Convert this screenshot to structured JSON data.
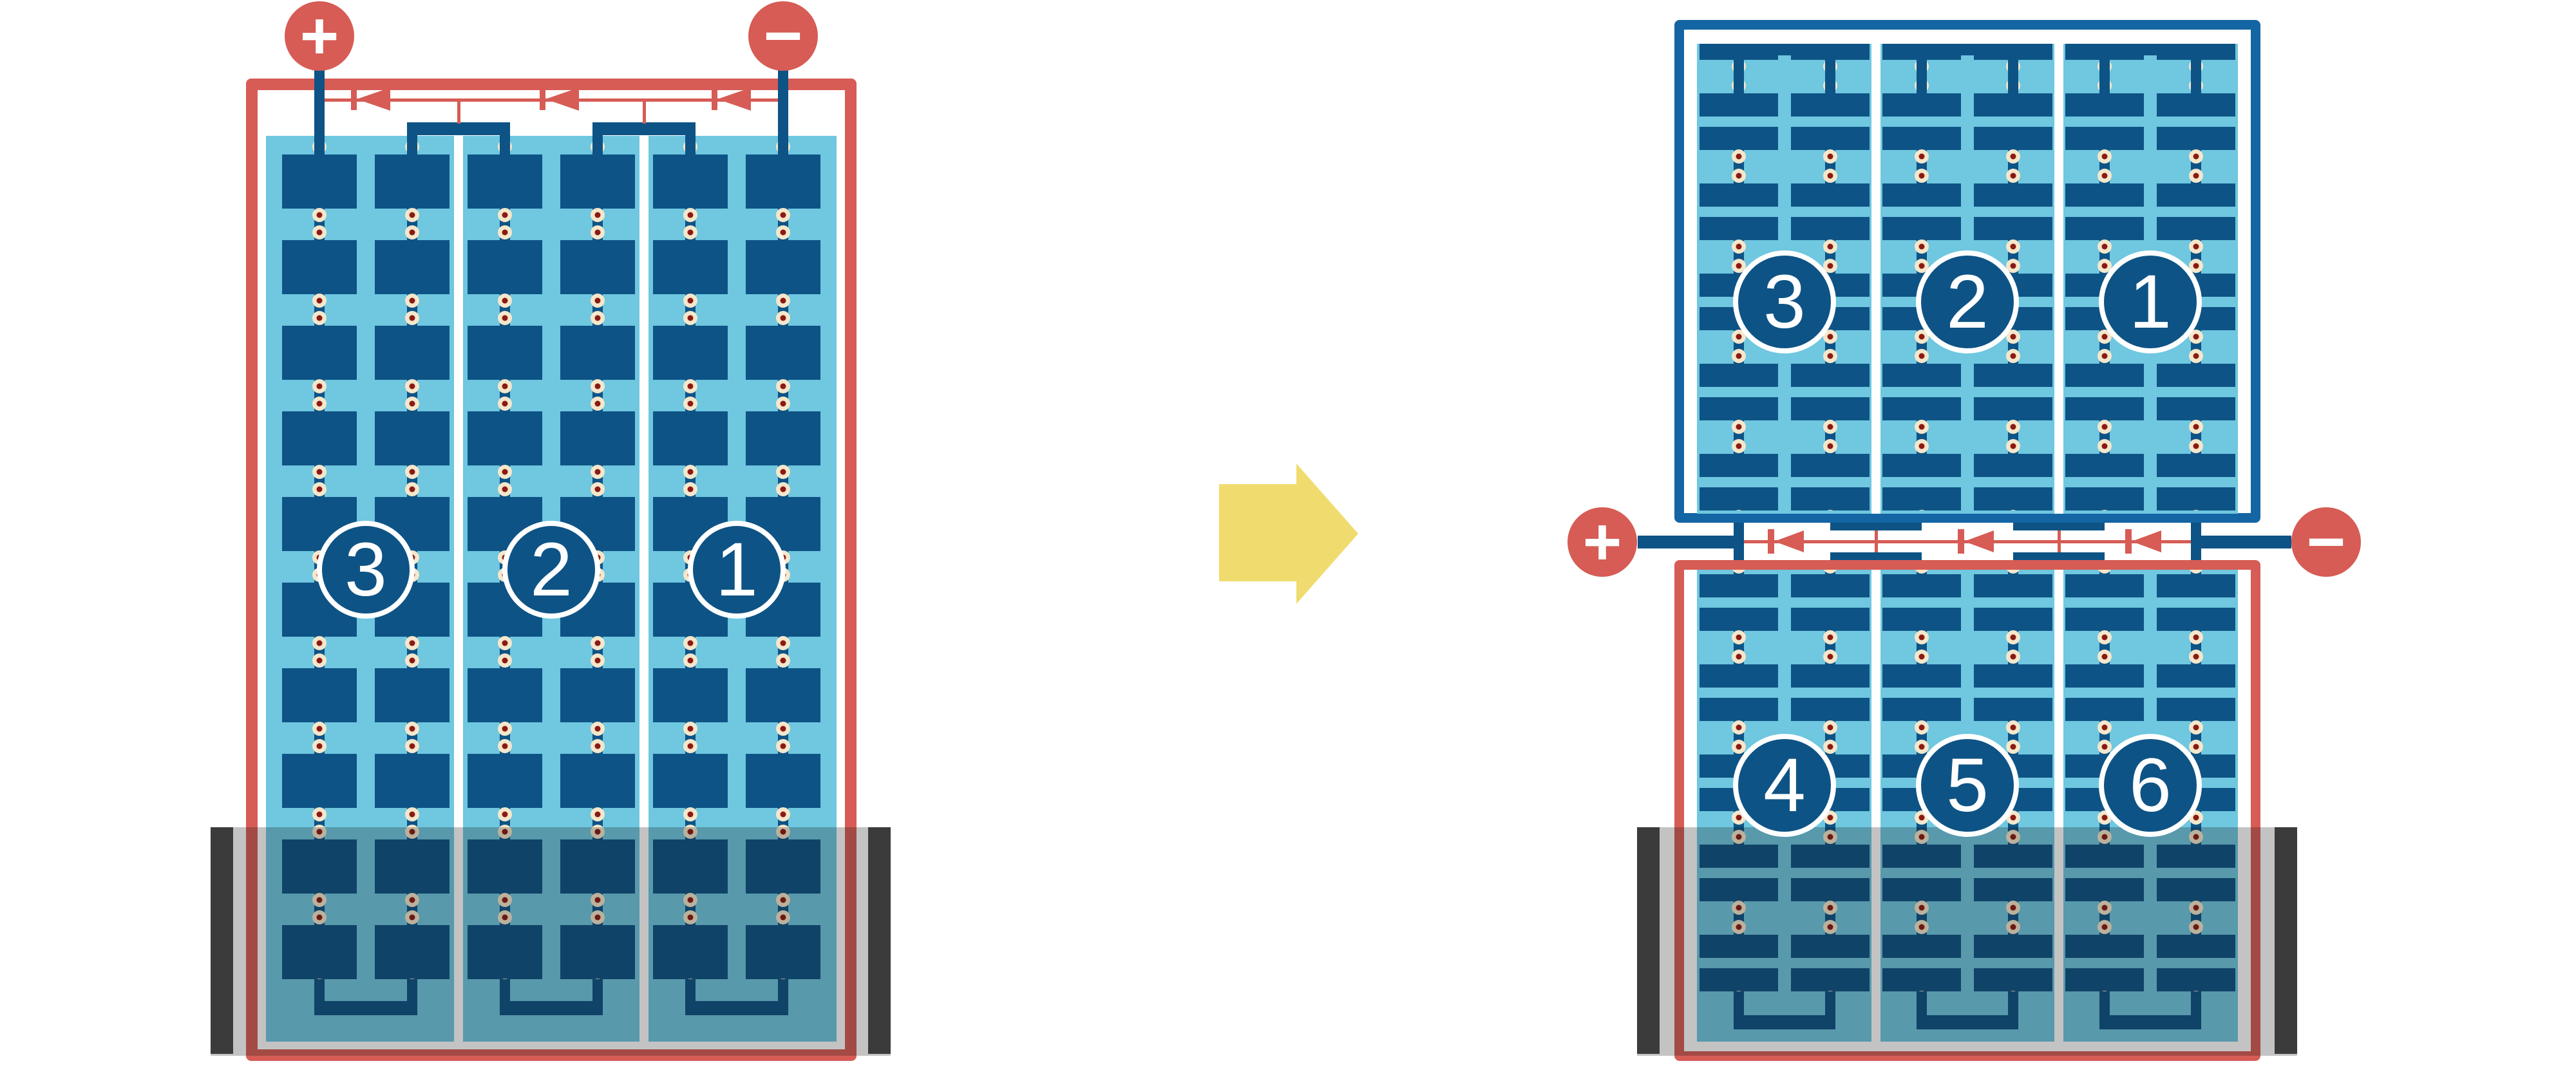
{
  "diagram": {
    "type": "solar-panel-bypass-diode-wiring",
    "left_panel": {
      "orientation": "portrait",
      "terminal_positive": "+",
      "terminal_negative": "−",
      "strings": [
        {
          "label": "3"
        },
        {
          "label": "2"
        },
        {
          "label": "1"
        }
      ],
      "shaded_region": "bottom"
    },
    "right_stack": {
      "terminal_positive": "+",
      "terminal_negative": "−",
      "top_module": {
        "strings": [
          {
            "label": "3"
          },
          {
            "label": "2"
          },
          {
            "label": "1"
          }
        ]
      },
      "bottom_module": {
        "strings": [
          {
            "label": "4"
          },
          {
            "label": "5"
          },
          {
            "label": "6"
          }
        ],
        "shaded_region": "bottom"
      }
    },
    "icons": {
      "transform_arrow": "right-arrow",
      "bypass_diode": "left-pointing-diode"
    },
    "colors": {
      "frame_red": "#D65C55",
      "frame_blue": "#1365A3",
      "cell_dark_blue": "#0E5385",
      "panel_light_blue": "#6FC7E0",
      "solder_cream": "#F4E7CC",
      "solder_center_red": "#8C1A12",
      "arrow_yellow": "#F0DC6E",
      "shadow_gray": "#3B3B3B"
    }
  }
}
